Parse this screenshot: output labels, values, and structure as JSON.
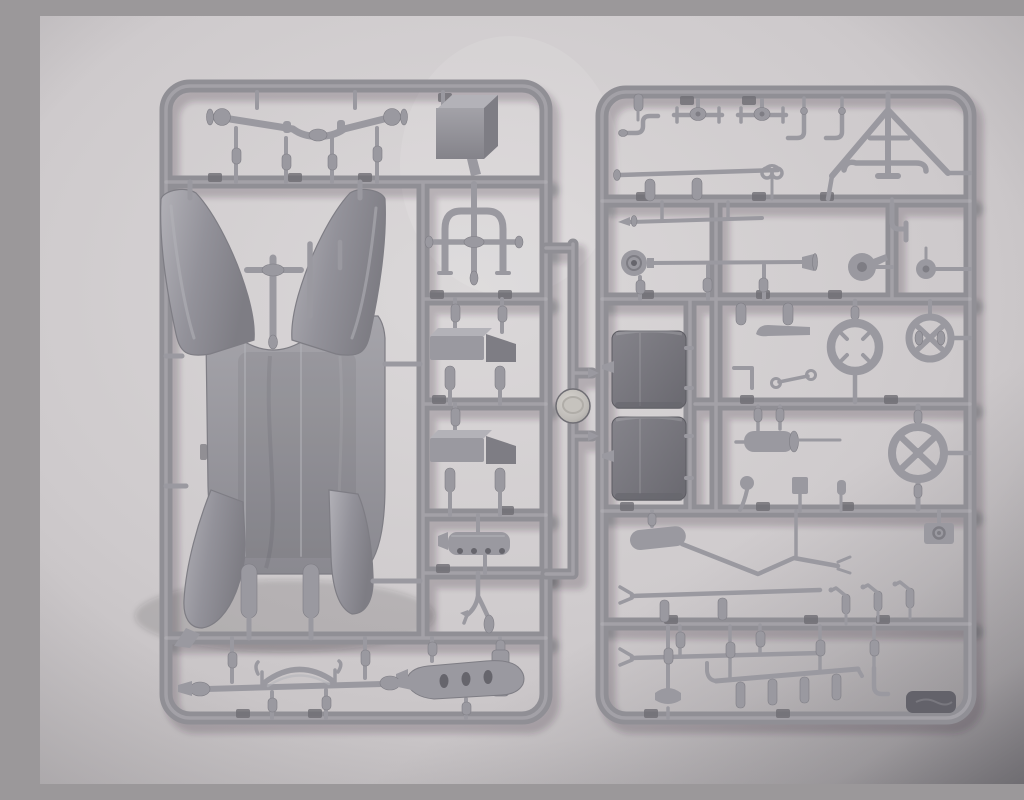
{
  "scene": {
    "subject": "Photograph of two grey injection-moulded plastic model-kit sprues laid on light paper",
    "left_sprue": "vehicle body shell, fenders, floor pan, axles, steps and chassis parts",
    "right_sprue": "small detail parts: hand wheels, fuel tanks, rods, levers, muffler, linkages",
    "connector": "short centre runner joining the sprues, with a round mould disc",
    "lighting": "soft top-left light, dark vignette toward bottom-right corner",
    "text_visible": "none"
  },
  "colors": {
    "background_light": "#dad7d8",
    "background_mid": "#cbc7c9",
    "background_edge": "#b7b3b5",
    "corner_shadow": "#3a3940",
    "runner": "#908f95",
    "runner_highlight": "#b5b4ba",
    "runner_shadow": "#6e6d73",
    "part": "#9a99a0",
    "part_light": "#b3b2b8",
    "part_dark": "#7e7d84",
    "part_darker": "#66656c",
    "tank_dark": "#75747b",
    "tab_dark": "#63626a",
    "disc_light": "#d6d3cf",
    "disc_mid": "#a9a6a3"
  },
  "sprues": {
    "left": {
      "name": "body-chassis-sprue",
      "parts": [
        "rear-axle-with-hubs",
        "storage-box",
        "arch-frame",
        "steering-column-rods",
        "body-floor-pan",
        "front-fender-panel-left",
        "front-fender-panel-right",
        "rear-fender-panel-left",
        "rear-fender-panel-right",
        "running-board-step-upper",
        "running-board-step-lower",
        "ribbed-cylinder-head",
        "shift-lever-bracket",
        "engine-oil-pan",
        "front-axle-with-leaf-spring"
      ]
    },
    "right": {
      "name": "detail-parts-sprue",
      "parts": [
        "starting-crank",
        "wheel-hub-spindle-1",
        "wheel-hub-spindle-2",
        "l-bracket-1",
        "l-bracket-2",
        "a-frame-radius-rod",
        "drive-shaft-rod",
        "tie-rod-thin",
        "pipe-hook",
        "horn-with-drum",
        "fan-pulley",
        "small-pulley",
        "curved-blade",
        "steering-wheel-rim",
        "spoked-hand-wheel-upper",
        "spoked-hand-wheel-lower",
        "fuel-tank-upper",
        "fuel-tank-lower",
        "eyelet-link",
        "angle-bracket",
        "muffler-with-tailpipe",
        "ball-handle-lever",
        "small-box-part",
        "bottle-part",
        "camera-box-part",
        "bent-linkage-with-cylinder",
        "tie-rod-forked-upper",
        "tie-rod-forked-lower",
        "spigot-lever-1",
        "spigot-lever-2",
        "spigot-lever-3",
        "seat-saddle-bracket",
        "peg-rack",
        "pipe-hook-bottom",
        "embossed-corner-tab"
      ]
    },
    "connector": {
      "name": "center-runner",
      "feature": "round-mold-disc"
    }
  }
}
